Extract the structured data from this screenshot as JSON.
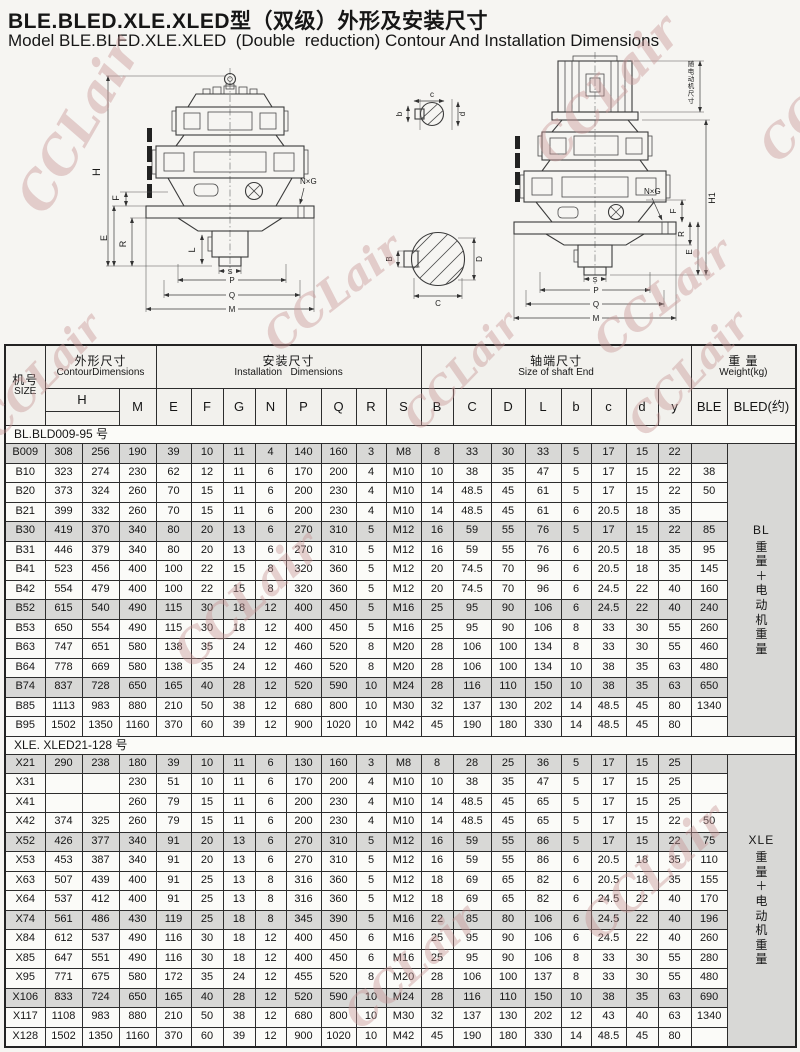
{
  "page": {
    "title_zh": "BLE.BLED.XLE.XLED型（双级）外形及安装尺寸",
    "title_en": "Model BLE.BLED.XLE.XLED  (Double  reduction) Contour And Installation Dimensions",
    "watermark": "CCLair",
    "colors": {
      "watermark": "#c69393",
      "row_shade": "#d8d8d6",
      "weight_cell": "#dcdcda"
    }
  },
  "drawings": {
    "left": {
      "labels": {
        "H": "H",
        "F": "F",
        "E": "E",
        "R": "R",
        "L": "L",
        "S": "S",
        "P": "P",
        "Q": "Q",
        "M": "M",
        "NXG": "N×G"
      }
    },
    "right": {
      "labels": {
        "motor_dim": "随电动机尺寸",
        "H1": "H1",
        "NXG": "N×G",
        "F": "F",
        "R": "R",
        "E": "E",
        "S": "S",
        "P": "P",
        "Q": "Q",
        "M": "M"
      }
    },
    "input_section": {
      "b": "b",
      "c": "c",
      "d": "d"
    },
    "output_section": {
      "B": "B",
      "C": "C",
      "D": "D"
    }
  },
  "table": {
    "header": {
      "size_zh": "机号",
      "size_en": "SIZE",
      "groups": [
        {
          "zh": "外形尺寸",
          "en": "ContourDimensions"
        },
        {
          "zh": "安装尺寸",
          "en": "Installation   Dimensions"
        },
        {
          "zh": "轴端尺寸",
          "en": "Size of shaft End"
        },
        {
          "zh": "重 量",
          "en": "Weight(kg)"
        }
      ],
      "h_label": "H",
      "cols": [
        "M",
        "E",
        "F",
        "G",
        "N",
        "P",
        "Q",
        "R",
        "S",
        "B",
        "C",
        "D",
        "L",
        "b",
        "c",
        "d",
        "y",
        "BLE",
        "BLED(约)"
      ]
    },
    "sections": [
      {
        "label": "BL.BLD009-95 号",
        "weight_prefix": "BL",
        "weight_chars": "重量＋电动机重量",
        "rows": [
          {
            "size": "B009",
            "values": [
              "308",
              "256",
              "190",
              "39",
              "10",
              "11",
              "4",
              "140",
              "160",
              "3",
              "M8",
              "8",
              "33",
              "30",
              "33",
              "5",
              "17",
              "15",
              "22",
              ""
            ]
          },
          {
            "size": "B10",
            "values": [
              "323",
              "274",
              "230",
              "62",
              "12",
              "11",
              "6",
              "170",
              "200",
              "4",
              "M10",
              "10",
              "38",
              "35",
              "47",
              "5",
              "17",
              "15",
              "22",
              "38"
            ]
          },
          {
            "size": "B20",
            "values": [
              "373",
              "324",
              "260",
              "70",
              "15",
              "11",
              "6",
              "200",
              "230",
              "4",
              "M10",
              "14",
              "48.5",
              "45",
              "61",
              "5",
              "17",
              "15",
              "22",
              "50"
            ]
          },
          {
            "size": "B21",
            "values": [
              "399",
              "332",
              "260",
              "70",
              "15",
              "11",
              "6",
              "200",
              "230",
              "4",
              "M10",
              "14",
              "48.5",
              "45",
              "61",
              "6",
              "20.5",
              "18",
              "35",
              ""
            ]
          },
          {
            "size": "B30",
            "values": [
              "419",
              "370",
              "340",
              "80",
              "20",
              "13",
              "6",
              "270",
              "310",
              "5",
              "M12",
              "16",
              "59",
              "55",
              "76",
              "5",
              "17",
              "15",
              "22",
              "85"
            ]
          },
          {
            "size": "B31",
            "values": [
              "446",
              "379",
              "340",
              "80",
              "20",
              "13",
              "6",
              "270",
              "310",
              "5",
              "M12",
              "16",
              "59",
              "55",
              "76",
              "6",
              "20.5",
              "18",
              "35",
              "95"
            ]
          },
          {
            "size": "B41",
            "values": [
              "523",
              "456",
              "400",
              "100",
              "22",
              "15",
              "8",
              "320",
              "360",
              "5",
              "M12",
              "20",
              "74.5",
              "70",
              "96",
              "6",
              "20.5",
              "18",
              "35",
              "145"
            ]
          },
          {
            "size": "B42",
            "values": [
              "554",
              "479",
              "400",
              "100",
              "22",
              "15",
              "8",
              "320",
              "360",
              "5",
              "M12",
              "20",
              "74.5",
              "70",
              "96",
              "6",
              "24.5",
              "22",
              "40",
              "160"
            ]
          },
          {
            "size": "B52",
            "values": [
              "615",
              "540",
              "490",
              "115",
              "30",
              "18",
              "12",
              "400",
              "450",
              "5",
              "M16",
              "25",
              "95",
              "90",
              "106",
              "6",
              "24.5",
              "22",
              "40",
              "240"
            ]
          },
          {
            "size": "B53",
            "values": [
              "650",
              "554",
              "490",
              "115",
              "30",
              "18",
              "12",
              "400",
              "450",
              "5",
              "M16",
              "25",
              "95",
              "90",
              "106",
              "8",
              "33",
              "30",
              "55",
              "260"
            ]
          },
          {
            "size": "B63",
            "values": [
              "747",
              "651",
              "580",
              "138",
              "35",
              "24",
              "12",
              "460",
              "520",
              "8",
              "M20",
              "28",
              "106",
              "100",
              "134",
              "8",
              "33",
              "30",
              "55",
              "460"
            ]
          },
          {
            "size": "B64",
            "values": [
              "778",
              "669",
              "580",
              "138",
              "35",
              "24",
              "12",
              "460",
              "520",
              "8",
              "M20",
              "28",
              "106",
              "100",
              "134",
              "10",
              "38",
              "35",
              "63",
              "480"
            ]
          },
          {
            "size": "B74",
            "values": [
              "837",
              "728",
              "650",
              "165",
              "40",
              "28",
              "12",
              "520",
              "590",
              "10",
              "M24",
              "28",
              "116",
              "110",
              "150",
              "10",
              "38",
              "35",
              "63",
              "650"
            ]
          },
          {
            "size": "B85",
            "values": [
              "1113",
              "983",
              "880",
              "210",
              "50",
              "38",
              "12",
              "680",
              "800",
              "10",
              "M30",
              "32",
              "137",
              "130",
              "202",
              "14",
              "48.5",
              "45",
              "80",
              "1340"
            ]
          },
          {
            "size": "B95",
            "values": [
              "1502",
              "1350",
              "1160",
              "370",
              "60",
              "39",
              "12",
              "900",
              "1020",
              "10",
              "M42",
              "45",
              "190",
              "180",
              "330",
              "14",
              "48.5",
              "45",
              "80",
              ""
            ]
          }
        ]
      },
      {
        "label": "XLE. XLED21-128 号",
        "weight_prefix": "XLE",
        "weight_chars": "重量＋电动机重量",
        "rows": [
          {
            "size": "X21",
            "values": [
              "290",
              "238",
              "180",
              "39",
              "10",
              "11",
              "6",
              "130",
              "160",
              "3",
              "M8",
              "8",
              "28",
              "25",
              "36",
              "5",
              "17",
              "15",
              "25",
              ""
            ]
          },
          {
            "size": "X31",
            "values": [
              "",
              "",
              "230",
              "51",
              "10",
              "11",
              "6",
              "170",
              "200",
              "4",
              "M10",
              "10",
              "38",
              "35",
              "47",
              "5",
              "17",
              "15",
              "25",
              ""
            ]
          },
          {
            "size": "X41",
            "values": [
              "",
              "",
              "260",
              "79",
              "15",
              "11",
              "6",
              "200",
              "230",
              "4",
              "M10",
              "14",
              "48.5",
              "45",
              "65",
              "5",
              "17",
              "15",
              "25",
              ""
            ]
          },
          {
            "size": "X42",
            "values": [
              "374",
              "325",
              "260",
              "79",
              "15",
              "11",
              "6",
              "200",
              "230",
              "4",
              "M10",
              "14",
              "48.5",
              "45",
              "65",
              "5",
              "17",
              "15",
              "22",
              "50"
            ]
          },
          {
            "size": "X52",
            "values": [
              "426",
              "377",
              "340",
              "91",
              "20",
              "13",
              "6",
              "270",
              "310",
              "5",
              "M12",
              "16",
              "59",
              "55",
              "86",
              "5",
              "17",
              "15",
              "22",
              "75"
            ]
          },
          {
            "size": "X53",
            "values": [
              "453",
              "387",
              "340",
              "91",
              "20",
              "13",
              "6",
              "270",
              "310",
              "5",
              "M12",
              "16",
              "59",
              "55",
              "86",
              "6",
              "20.5",
              "18",
              "35",
              "110"
            ]
          },
          {
            "size": "X63",
            "values": [
              "507",
              "439",
              "400",
              "91",
              "25",
              "13",
              "8",
              "316",
              "360",
              "5",
              "M12",
              "18",
              "69",
              "65",
              "82",
              "6",
              "20.5",
              "18",
              "35",
              "155"
            ]
          },
          {
            "size": "X64",
            "values": [
              "537",
              "412",
              "400",
              "91",
              "25",
              "13",
              "8",
              "316",
              "360",
              "5",
              "M12",
              "18",
              "69",
              "65",
              "82",
              "6",
              "24.5",
              "22",
              "40",
              "170"
            ]
          },
          {
            "size": "X74",
            "values": [
              "561",
              "486",
              "430",
              "119",
              "25",
              "18",
              "8",
              "345",
              "390",
              "5",
              "M16",
              "22",
              "85",
              "80",
              "106",
              "6",
              "24.5",
              "22",
              "40",
              "196"
            ]
          },
          {
            "size": "X84",
            "values": [
              "612",
              "537",
              "490",
              "116",
              "30",
              "18",
              "12",
              "400",
              "450",
              "6",
              "M16",
              "25",
              "95",
              "90",
              "106",
              "6",
              "24.5",
              "22",
              "40",
              "260"
            ]
          },
          {
            "size": "X85",
            "values": [
              "647",
              "551",
              "490",
              "116",
              "30",
              "18",
              "12",
              "400",
              "450",
              "6",
              "M16",
              "25",
              "95",
              "90",
              "106",
              "8",
              "33",
              "30",
              "55",
              "280"
            ]
          },
          {
            "size": "X95",
            "values": [
              "771",
              "675",
              "580",
              "172",
              "35",
              "24",
              "12",
              "455",
              "520",
              "8",
              "M20",
              "28",
              "106",
              "100",
              "137",
              "8",
              "33",
              "30",
              "55",
              "480"
            ]
          },
          {
            "size": "X106",
            "values": [
              "833",
              "724",
              "650",
              "165",
              "40",
              "28",
              "12",
              "520",
              "590",
              "10",
              "M24",
              "28",
              "116",
              "110",
              "150",
              "10",
              "38",
              "35",
              "63",
              "690"
            ]
          },
          {
            "size": "X117",
            "values": [
              "1108",
              "983",
              "880",
              "210",
              "50",
              "38",
              "12",
              "680",
              "800",
              "10",
              "M30",
              "32",
              "137",
              "130",
              "202",
              "12",
              "43",
              "40",
              "63",
              "1340"
            ]
          },
          {
            "size": "X128",
            "values": [
              "1502",
              "1350",
              "1160",
              "370",
              "60",
              "39",
              "12",
              "900",
              "1020",
              "10",
              "M42",
              "45",
              "190",
              "180",
              "330",
              "14",
              "48.5",
              "45",
              "80",
              ""
            ]
          }
        ]
      }
    ]
  }
}
